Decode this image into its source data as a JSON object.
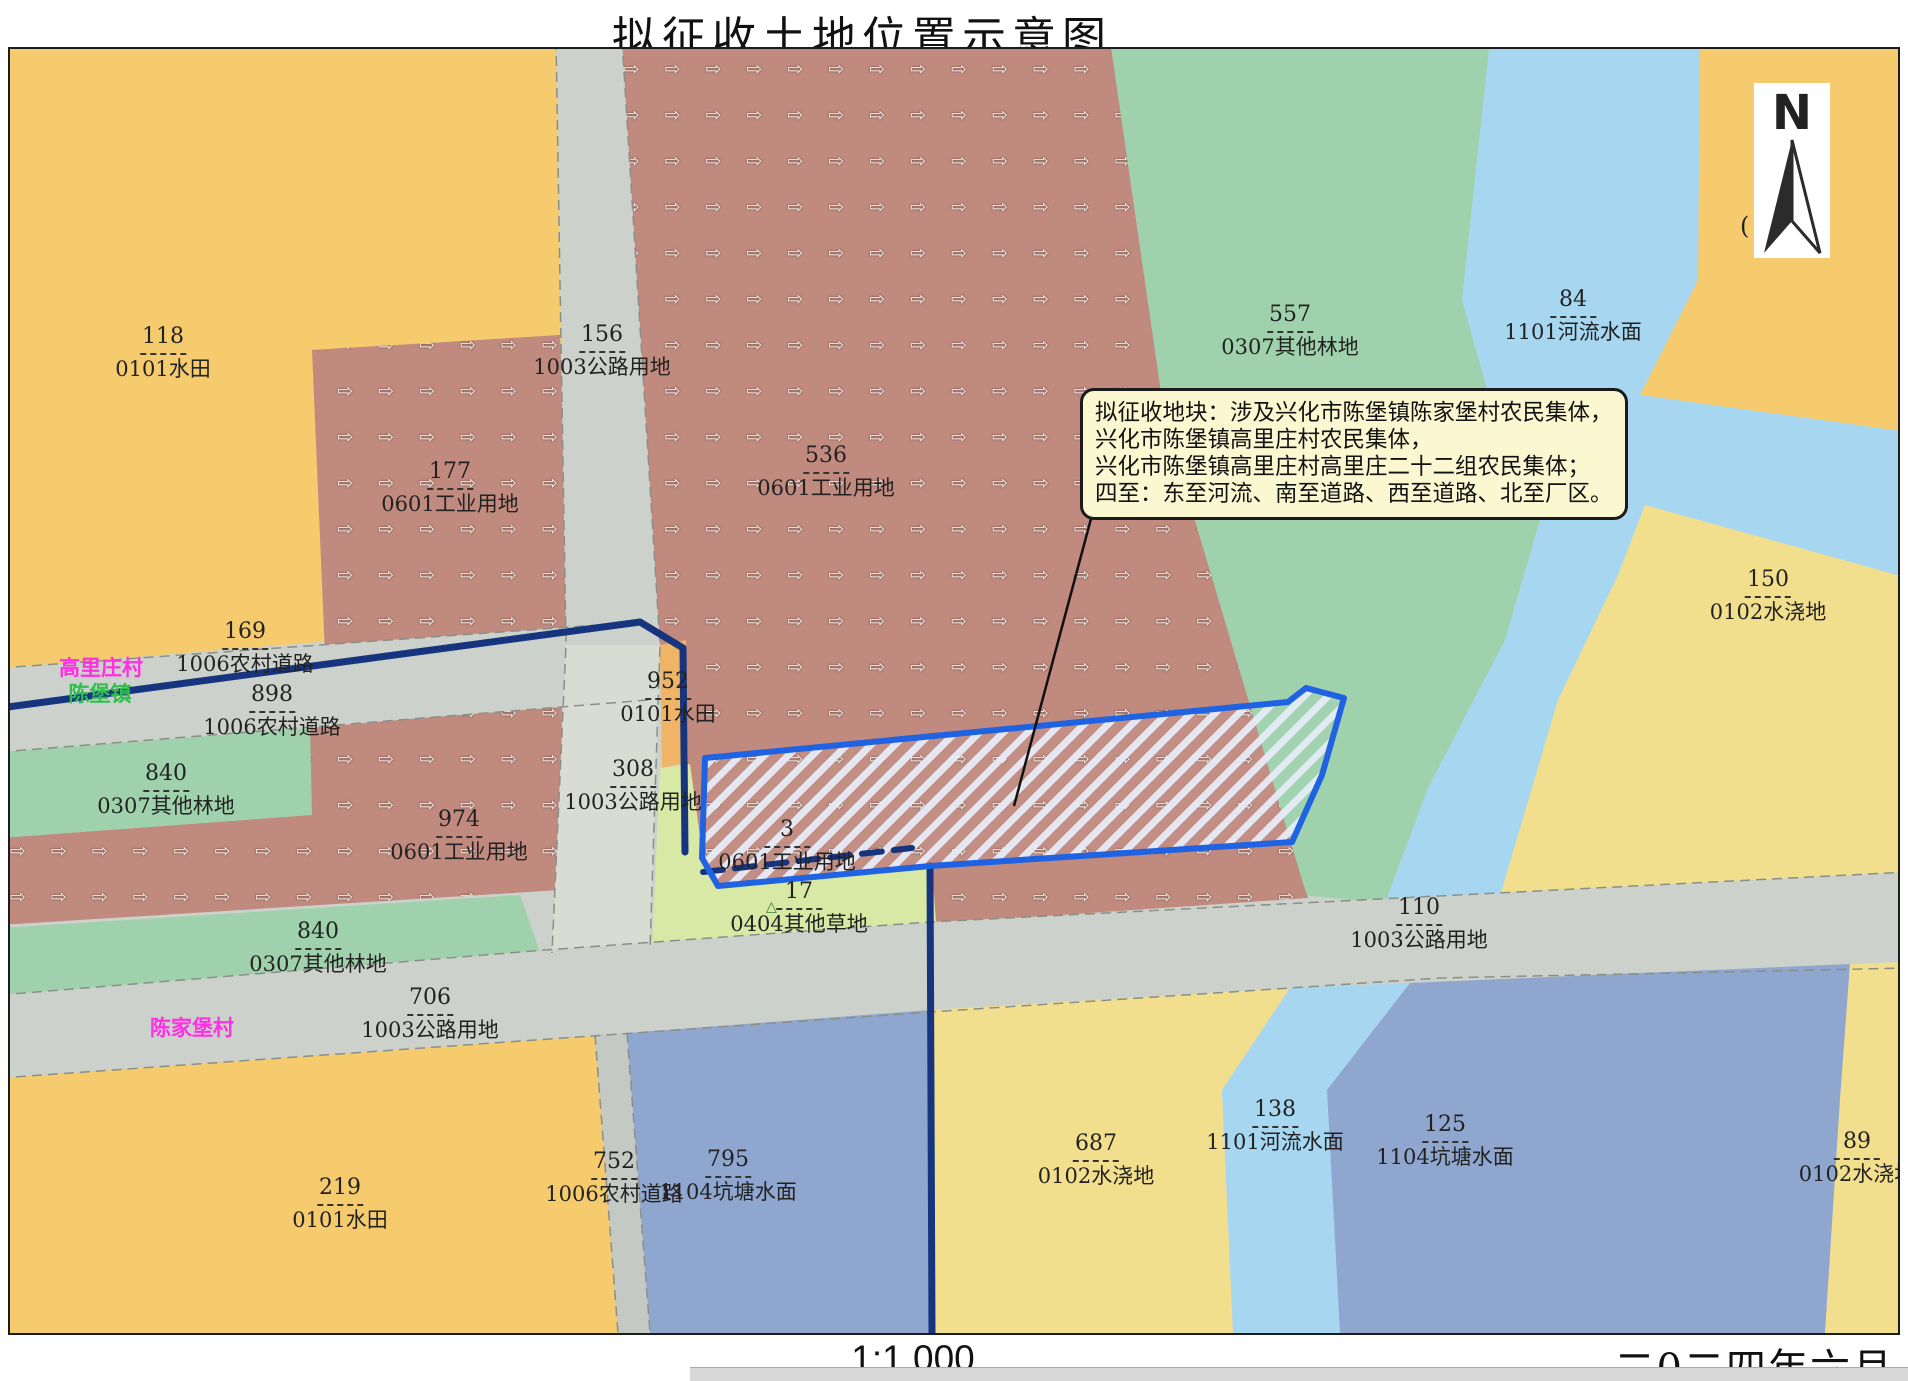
{
  "title": "拟征收土地位置示意图",
  "scale_text": "1:1,000",
  "date_text": "二0二四年六月",
  "compass": {
    "letter": "N",
    "icon": "north-arrow"
  },
  "misc": {
    "stray_glyph": "(",
    "grass_symbol": "△"
  },
  "callout": {
    "lines": [
      "拟征收地块：涉及兴化市陈堡镇陈家堡村农民集体，",
      "兴化市陈堡镇高里庄村农民集体，",
      "兴化市陈堡镇高里庄村高里庄二十二组农民集体；",
      "四至：东至河流、南至道路、西至道路、北至厂区。"
    ]
  },
  "villages": [
    {
      "name": "高里庄村",
      "color": "#FF2FE3",
      "x": 101,
      "y": 652
    },
    {
      "name": "陈堡镇",
      "color": "#2FBF4F",
      "x": 100,
      "y": 678
    },
    {
      "name": "陈家堡村",
      "color": "#FF2FE3",
      "x": 192,
      "y": 1012
    }
  ],
  "parcel_labels": [
    {
      "num": "118",
      "name": "0101水田",
      "x": 163,
      "y": 325
    },
    {
      "num": "156",
      "name": "1003公路用地",
      "x": 602,
      "y": 323
    },
    {
      "num": "177",
      "name": "0601工业用地",
      "x": 450,
      "y": 460
    },
    {
      "num": "536",
      "name": "0601工业用地",
      "x": 826,
      "y": 444
    },
    {
      "num": "557",
      "name": "0307其他林地",
      "x": 1290,
      "y": 303
    },
    {
      "num": "84",
      "name": "1101河流水面",
      "x": 1573,
      "y": 288
    },
    {
      "num": "150",
      "name": "0102水浇地",
      "x": 1768,
      "y": 568
    },
    {
      "num": "169",
      "name": "1006农村道路",
      "x": 245,
      "y": 620
    },
    {
      "num": "898",
      "name": "1006农村道路",
      "x": 272,
      "y": 683
    },
    {
      "num": "840",
      "name": "0307其他林地",
      "x": 166,
      "y": 762
    },
    {
      "num": "952",
      "name": "0101水田",
      "x": 668,
      "y": 670
    },
    {
      "num": "308",
      "name": "1003公路用地",
      "x": 633,
      "y": 758
    },
    {
      "num": "974",
      "name": "0601工业用地",
      "x": 459,
      "y": 808
    },
    {
      "num": "3",
      "name": "0601工业用地",
      "x": 787,
      "y": 818
    },
    {
      "num": "17",
      "name": "0404其他草地",
      "x": 799,
      "y": 880
    },
    {
      "num": "840",
      "name": "0307其他林地",
      "x": 318,
      "y": 920
    },
    {
      "num": "706",
      "name": "1003公路用地",
      "x": 430,
      "y": 986
    },
    {
      "num": "110",
      "name": "1003公路用地",
      "x": 1419,
      "y": 896
    },
    {
      "num": "219",
      "name": "0101水田",
      "x": 340,
      "y": 1176
    },
    {
      "num": "752",
      "name": "1006农村道路",
      "x": 614,
      "y": 1150
    },
    {
      "num": "795",
      "name": "1104坑塘水面",
      "x": 728,
      "y": 1148
    },
    {
      "num": "687",
      "name": "0102水浇地",
      "x": 1096,
      "y": 1132
    },
    {
      "num": "138",
      "name": "1101河流水面",
      "x": 1275,
      "y": 1098
    },
    {
      "num": "125",
      "name": "1104坑塘水面",
      "x": 1445,
      "y": 1113
    },
    {
      "num": "89",
      "name": "0102水浇地",
      "x": 1857,
      "y": 1130
    }
  ],
  "colors": {
    "paddy_yellow": "#F5CB6E",
    "irrigated_yellow": "#F2DF8D",
    "forest_green": "#9FD2AC",
    "river_blue": "#A6D6F0",
    "pond_blue": "#8FA6CE",
    "road_gray": "#CDD1CB",
    "industrial_brown": "#C18A7E",
    "grass_green": "#D8E9A5",
    "boundary_navy": "#16357E",
    "parcel_blue": "#1F63E3",
    "callout_bg": "#FBF7D0"
  }
}
